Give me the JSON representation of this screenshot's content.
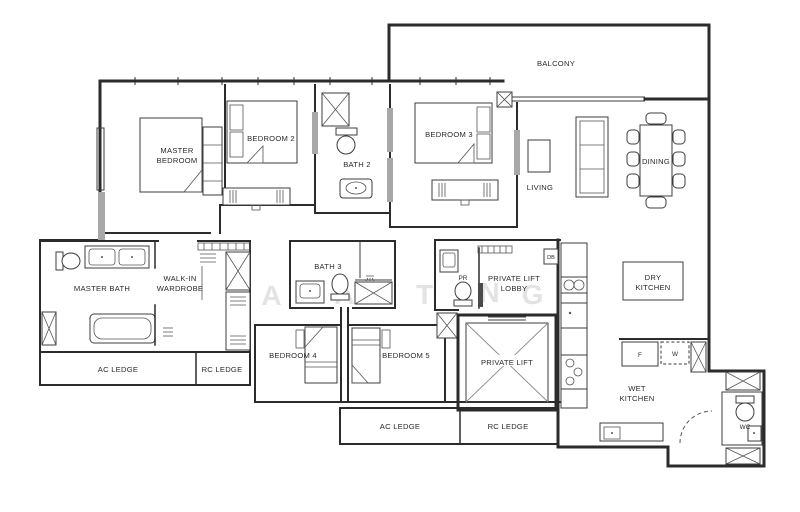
{
  "meta": {
    "type": "apartment-floor-plan",
    "background_color": "#ffffff",
    "wall_color": "#2b2b2b",
    "text_color": "#2a2a2a",
    "watermark_color": "#e3e3e3"
  },
  "labels": {
    "balcony": "BALCONY",
    "master_bedroom_line1": "MASTER",
    "master_bedroom_line2": "BEDROOM",
    "bedroom2": "BEDROOM 2",
    "bath2": "BATH 2",
    "bedroom3": "BEDROOM 3",
    "living": "LIVING",
    "dining": "DINING",
    "master_bath": "MASTER BATH",
    "walkin_line1": "WALK-IN",
    "walkin_line2": "WARDROBE",
    "bath3": "BATH 3",
    "pr": "PR",
    "lift_lobby_line1": "PRIVATE LIFT",
    "lift_lobby_line2": "LOBBY",
    "db": "DB",
    "private_lift": "PRIVATE LIFT",
    "bedroom4": "BEDROOM 4",
    "bedroom5": "BEDROOM 5",
    "dry_kitchen_line1": "DRY",
    "dry_kitchen_line2": "KITCHEN",
    "wet_kitchen_line1": "WET",
    "wet_kitchen_line2": "KITCHEN",
    "ac_ledge_left": "AC LEDGE",
    "rc_ledge_left": "RC LEDGE",
    "ac_ledge_bottom": "AC LEDGE",
    "rc_ledge_bottom": "RC LEDGE",
    "fridge": "F",
    "washer": "W",
    "wc": "WC"
  },
  "watermark": {
    "letters": [
      "A",
      "A",
      "T",
      "N",
      "G"
    ]
  }
}
